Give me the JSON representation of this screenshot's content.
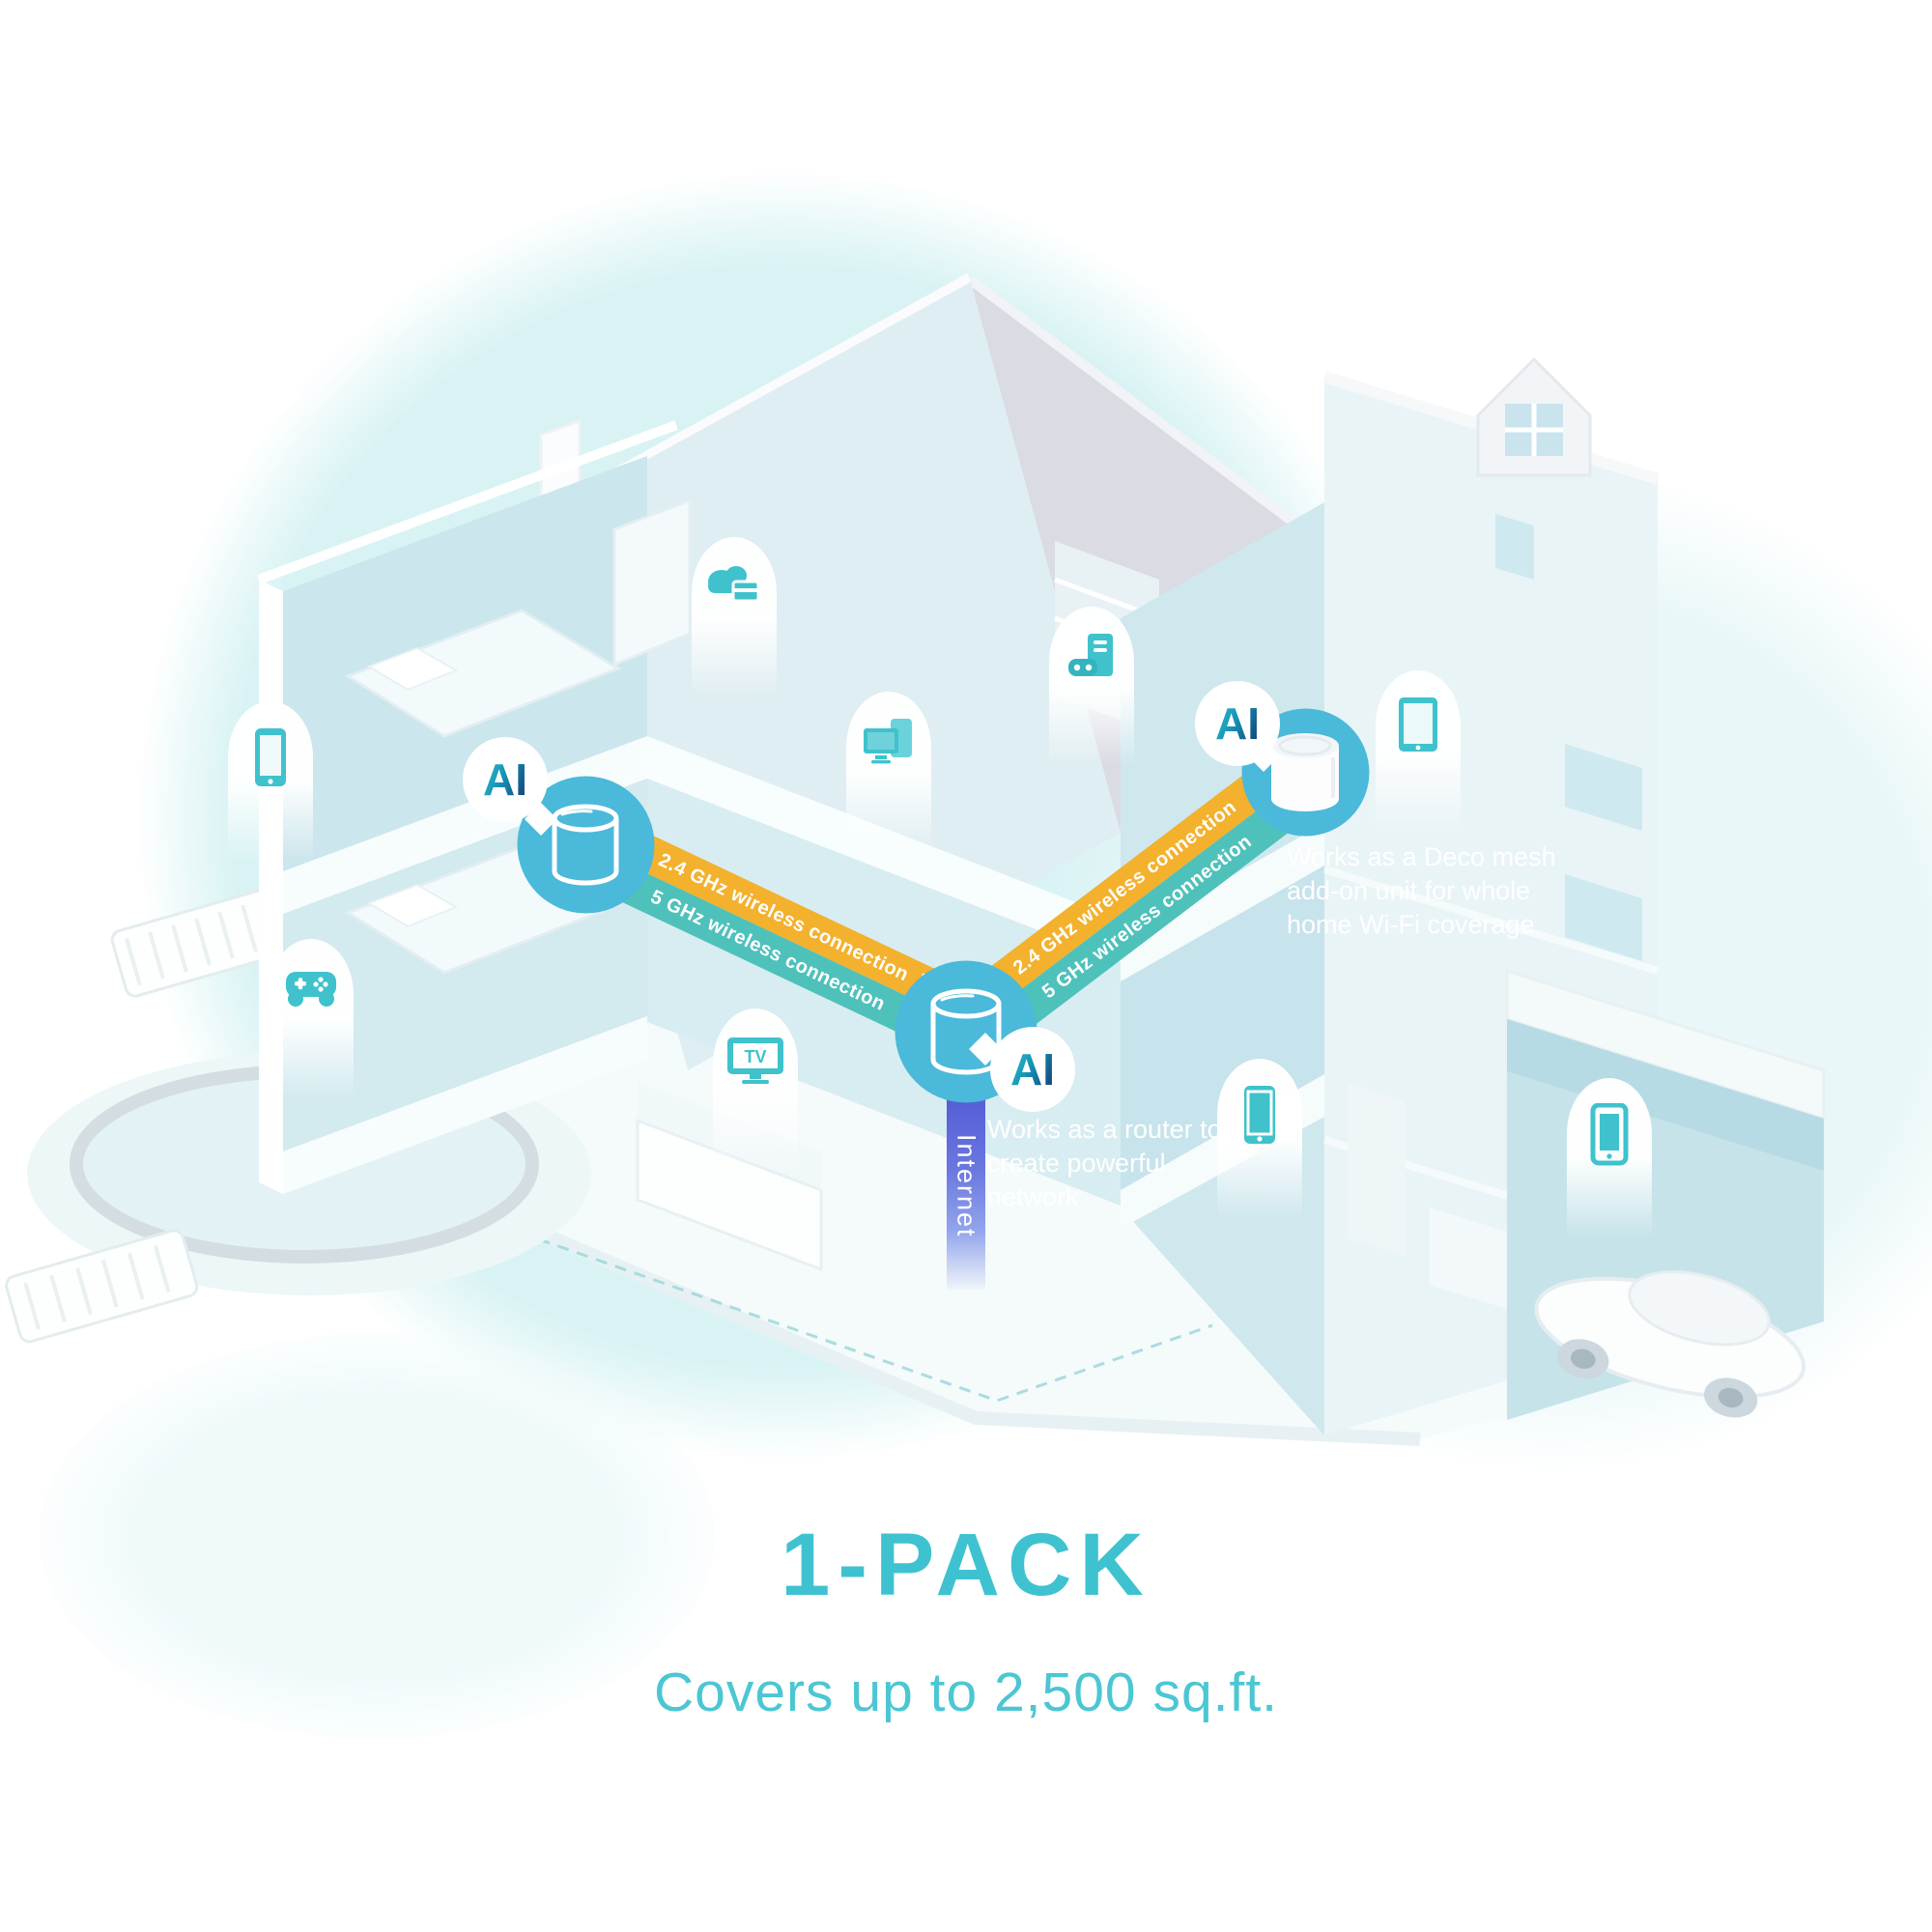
{
  "headline": {
    "pack_label": "1-PACK",
    "coverage_text": "Covers up to 2,500 sq.ft."
  },
  "connection_bands": {
    "ghz24_label": "2.4 GHz wireless connection",
    "ghz5_label": "5 GHz wireless connection"
  },
  "internet": {
    "label": "Internet"
  },
  "deco_units": {
    "left_unit": {
      "ai_badge": "AI"
    },
    "main_router": {
      "ai_badge": "AI",
      "caption": "Works as a router to create powerful network"
    },
    "mesh_addon": {
      "ai_badge": "AI",
      "caption": "Works as a Deco mesh add-on unit for whole home Wi-Fi coverage"
    }
  },
  "device_markers": {
    "tv_label": "TV",
    "items": [
      "smartphone-bedroom",
      "game-controller-patio",
      "cloud-storage-laundry",
      "computer-screens-hallway",
      "vr-gaming-pc-study",
      "tablet-attic",
      "tv-living-room",
      "smartphone-bathroom",
      "smartphone-garage"
    ]
  },
  "colors": {
    "accent_teal": "#41c2d0",
    "icon_teal": "#3fc2cc",
    "deco_circle_blue": "#4bb9d9",
    "band_yellow": "#f3b12e",
    "band_teal": "#4fc1bb",
    "internet_indigo": "#5a62d7"
  }
}
